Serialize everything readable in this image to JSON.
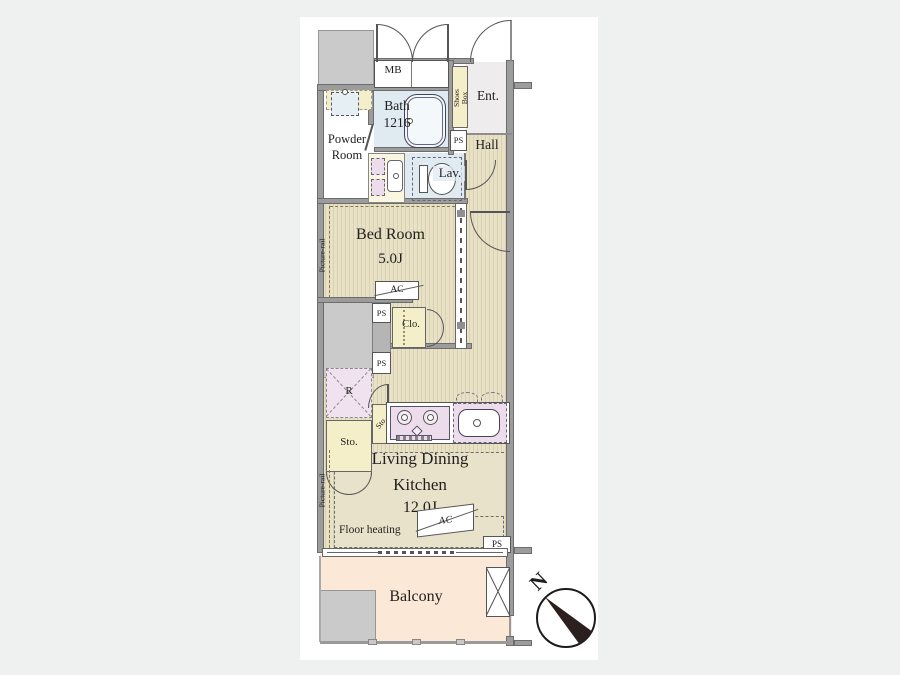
{
  "floorplan": {
    "compass_label": "N",
    "rooms": {
      "mb": "MB",
      "bath_line1": "Bath",
      "bath_line2": "1216",
      "powder_line1": "Powder",
      "powder_line2": "Room",
      "shoes_line1": "Shoes",
      "shoes_line2": "Box",
      "entrance": "Ent.",
      "hall": "Hall",
      "lavatory": "Lav.",
      "ps": "PS",
      "bedroom_name": "Bed Room",
      "bedroom_size": "5.0J",
      "picture_rail": "Picture-rail",
      "ac": "AC",
      "closet": "Clo.",
      "storage": "Sto.",
      "refrigerator": "R",
      "ldk_line1": "Living Dining",
      "ldk_line2": "Kitchen",
      "ldk_size": "12.0J",
      "floor_heating": "Floor heating",
      "balcony": "Balcony"
    }
  }
}
